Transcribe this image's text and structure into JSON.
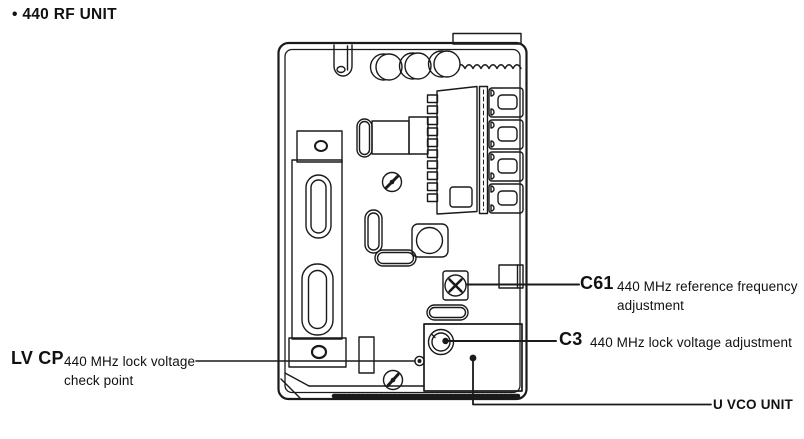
{
  "page": {
    "background_color": "#ffffff",
    "ink_color": "#1a1a1a"
  },
  "title": "• 440 RF UNIT",
  "callouts": {
    "c61": {
      "ref": "C61",
      "desc": "440 MHz reference frequency adjustment"
    },
    "c3": {
      "ref": "C3",
      "desc": "440 MHz lock voltage adjustment"
    },
    "lvcp": {
      "ref": "LV CP",
      "desc": "440 MHz lock voltage check point"
    },
    "uvco": {
      "ref": "U VCO UNIT"
    }
  }
}
